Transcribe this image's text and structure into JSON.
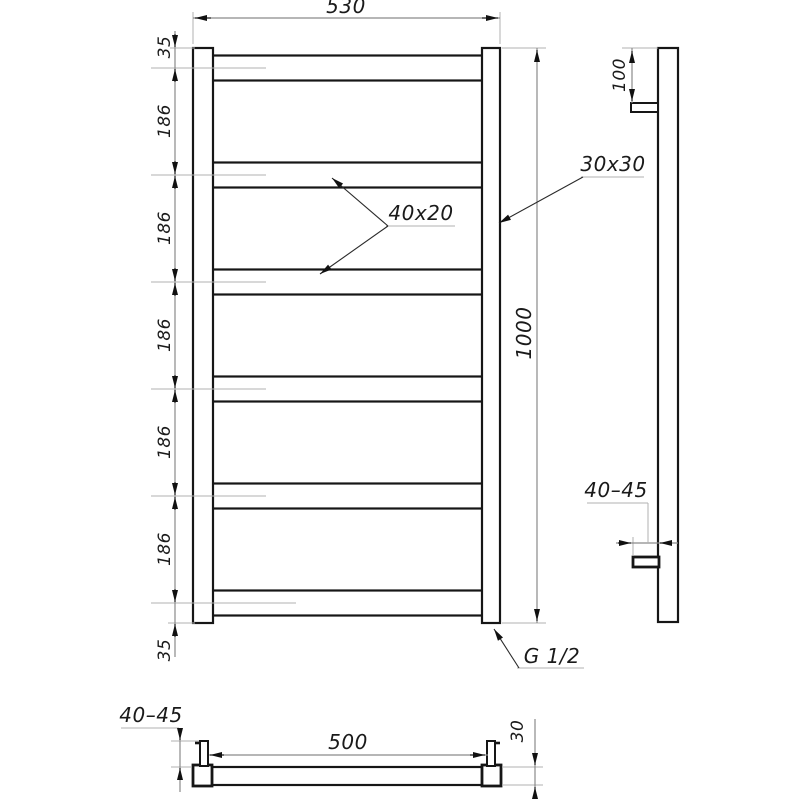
{
  "drawing_type": "towel-rail ladder technical drawing, three orthographic views",
  "colors": {
    "background": "#ffffff",
    "geometry_line": "#161616",
    "dimension_line": "#8a8a8a",
    "extension_line": "#b0b0b0",
    "arrow": "#111111",
    "text": "#1a1a1a"
  },
  "front_view": {
    "rung_count": 6,
    "overall_width": "530",
    "overall_height": "1000",
    "left_chain": [
      "35",
      "186",
      "186",
      "186",
      "186",
      "186",
      "35"
    ],
    "rung_profile_label": "40x20",
    "post_profile_label": "30x30",
    "connection_label": "G 1/2"
  },
  "side_view": {
    "top_bracket_offset": "100",
    "wall_clearance": "40–45"
  },
  "bottom_view": {
    "wall_clearance": "40–45",
    "bracket_spacing": "500",
    "tube_depth": "30"
  }
}
